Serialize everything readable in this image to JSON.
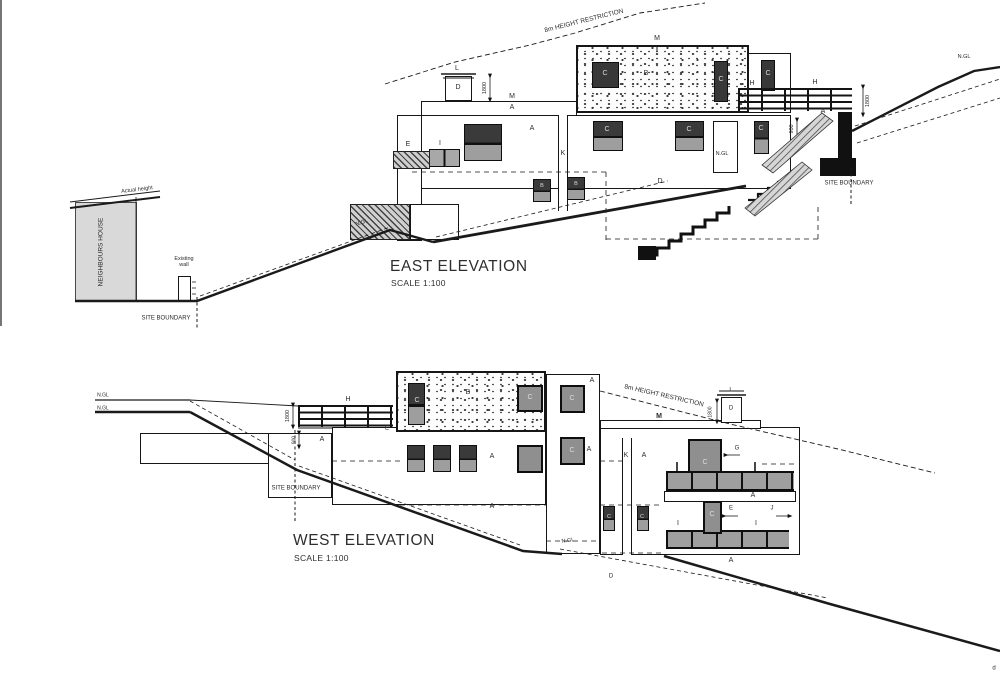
{
  "sheet": {
    "background": "#ffffff",
    "ink": "#1a1a1a"
  },
  "east": {
    "title": "EAST ELEVATION",
    "scale": "SCALE 1:100",
    "annotations": [
      {
        "n": "height-restriction-label",
        "t": "8m HEIGHT RESTRICTION",
        "x": 584,
        "y": 21,
        "rot": -14,
        "size": 6.5
      },
      {
        "n": "neighbours-house-label",
        "t": "NEIGHBOURS HOUSE",
        "x": 101,
        "y": 252,
        "rot": -90,
        "size": 6.5
      },
      {
        "n": "actual-height-label",
        "t": "Actual height",
        "x": 137,
        "y": 190,
        "rot": -7,
        "size": 5.5
      },
      {
        "n": "existing-wall-label",
        "t": "Existing wall",
        "x": 184,
        "y": 262,
        "size": 5.5,
        "w": 28
      },
      {
        "n": "site-boundary-label",
        "t": "SITE BOUNDARY",
        "x": 166,
        "y": 319,
        "size": 6
      },
      {
        "n": "site-boundary-label",
        "t": "SITE BOUNDARY",
        "x": 849,
        "y": 184,
        "size": 6
      },
      {
        "n": "dim-1800",
        "t": "1800",
        "x": 485,
        "y": 88,
        "rot": -90,
        "size": 5.5
      },
      {
        "n": "dim-1800",
        "t": "1800",
        "x": 868,
        "y": 101,
        "rot": -90,
        "size": 5.5
      },
      {
        "n": "dim-900",
        "t": "900",
        "x": 792,
        "y": 129,
        "rot": -90,
        "size": 5.5
      },
      {
        "n": "ngl-label",
        "t": "N.GL",
        "x": 362,
        "y": 223,
        "rot": -18,
        "size": 5.5
      },
      {
        "n": "ngl-label",
        "t": "N.GL",
        "x": 722,
        "y": 154,
        "size": 5.5
      },
      {
        "n": "ngl-label",
        "t": "N.GL",
        "x": 964,
        "y": 57,
        "size": 5.5
      },
      {
        "t": "M",
        "x": 657,
        "y": 39
      },
      {
        "t": "L",
        "x": 457,
        "y": 69
      },
      {
        "t": "D",
        "x": 458,
        "y": 88
      },
      {
        "t": "M",
        "x": 512,
        "y": 97
      },
      {
        "t": "A",
        "x": 512,
        "y": 108
      },
      {
        "t": "B",
        "x": 646,
        "y": 74
      },
      {
        "t": "C",
        "x": 605,
        "y": 74,
        "light": 1
      },
      {
        "t": "C",
        "x": 721,
        "y": 80,
        "light": 1
      },
      {
        "t": "C",
        "x": 768,
        "y": 74,
        "light": 1
      },
      {
        "t": "H",
        "x": 752,
        "y": 84
      },
      {
        "t": "H",
        "x": 815,
        "y": 83
      },
      {
        "t": "A",
        "x": 823,
        "y": 112
      },
      {
        "t": "E",
        "x": 408,
        "y": 145
      },
      {
        "t": "I",
        "x": 440,
        "y": 144
      },
      {
        "t": "A",
        "x": 532,
        "y": 129
      },
      {
        "t": "C",
        "x": 607,
        "y": 130,
        "light": 1
      },
      {
        "t": "C",
        "x": 689,
        "y": 130,
        "light": 1
      },
      {
        "t": "C",
        "x": 761,
        "y": 129,
        "light": 1
      },
      {
        "t": "K",
        "x": 563,
        "y": 154
      },
      {
        "t": "D",
        "x": 660,
        "y": 182
      },
      {
        "t": "B",
        "x": 542,
        "y": 186,
        "light": 1,
        "size": 5.5
      },
      {
        "t": "B",
        "x": 576,
        "y": 184,
        "light": 1,
        "size": 5.5
      }
    ]
  },
  "west": {
    "title": "WEST ELEVATION",
    "scale": "SCALE 1:100",
    "annotations": [
      {
        "n": "height-restriction-label",
        "t": "8m HEIGHT RESTRICTION",
        "x": 664,
        "y": 396,
        "rot": 13,
        "size": 6.5
      },
      {
        "n": "site-boundary-label",
        "t": "SITE BOUNDARY",
        "x": 296,
        "y": 489,
        "size": 6
      },
      {
        "n": "ngl-label",
        "t": "N.GL",
        "x": 103,
        "y": 396,
        "size": 5
      },
      {
        "n": "ngl-label",
        "t": "N.GL",
        "x": 103,
        "y": 409,
        "size": 5
      },
      {
        "n": "dim-1800",
        "t": "1800",
        "x": 288,
        "y": 416,
        "rot": -90,
        "size": 5.5
      },
      {
        "n": "dim-900",
        "t": "900",
        "x": 295,
        "y": 440,
        "rot": -90,
        "size": 5
      },
      {
        "n": "dim-1800",
        "t": "1800",
        "x": 711,
        "y": 412,
        "rot": -90,
        "size": 5
      },
      {
        "t": "H",
        "x": 348,
        "y": 400
      },
      {
        "t": "A",
        "x": 322,
        "y": 440
      },
      {
        "t": "E",
        "x": 387,
        "y": 429,
        "size": 6
      },
      {
        "t": "B",
        "x": 468,
        "y": 393
      },
      {
        "t": "C",
        "x": 417,
        "y": 401,
        "light": 1
      },
      {
        "t": "C",
        "x": 530,
        "y": 398,
        "light": 1
      },
      {
        "t": "A",
        "x": 592,
        "y": 381
      },
      {
        "t": "C",
        "x": 572,
        "y": 399,
        "light": 1
      },
      {
        "t": "A",
        "x": 589,
        "y": 450
      },
      {
        "t": "C",
        "x": 572,
        "y": 451,
        "light": 1
      },
      {
        "t": "M",
        "x": 659,
        "y": 417,
        "bold": 1
      },
      {
        "t": "L",
        "x": 731,
        "y": 391,
        "size": 6
      },
      {
        "t": "D",
        "x": 731,
        "y": 409,
        "size": 6
      },
      {
        "t": "K",
        "x": 626,
        "y": 456
      },
      {
        "t": "A",
        "x": 644,
        "y": 456
      },
      {
        "t": "C",
        "x": 705,
        "y": 463,
        "light": 1
      },
      {
        "t": "G",
        "x": 737,
        "y": 449,
        "size": 6
      },
      {
        "t": "A",
        "x": 753,
        "y": 496
      },
      {
        "t": "C",
        "x": 609,
        "y": 517,
        "light": 1,
        "size": 5.5
      },
      {
        "t": "C",
        "x": 642,
        "y": 517,
        "light": 1,
        "size": 5.5
      },
      {
        "t": "C",
        "x": 712,
        "y": 515,
        "light": 1
      },
      {
        "t": "I",
        "x": 678,
        "y": 524
      },
      {
        "t": "I",
        "x": 756,
        "y": 524
      },
      {
        "t": "E",
        "x": 731,
        "y": 509,
        "size": 6
      },
      {
        "t": "J",
        "x": 772,
        "y": 509,
        "size": 6
      },
      {
        "t": "A",
        "x": 492,
        "y": 457
      },
      {
        "t": "A",
        "x": 492,
        "y": 507
      },
      {
        "t": "A",
        "x": 731,
        "y": 561
      },
      {
        "t": "D",
        "x": 611,
        "y": 577,
        "size": 6
      },
      {
        "n": "ngl-label",
        "t": "N.GL",
        "x": 568,
        "y": 541,
        "rot": -8,
        "size": 5.5
      },
      {
        "n": "edge-text",
        "t": "d",
        "x": 994,
        "y": 669,
        "size": 6
      }
    ]
  }
}
